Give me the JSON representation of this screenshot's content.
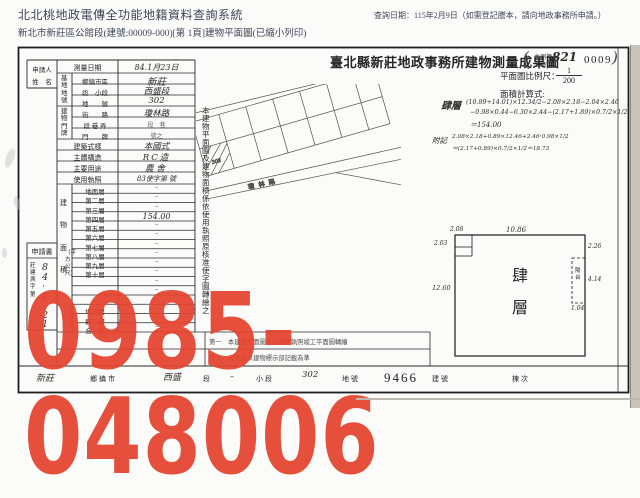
{
  "header": {
    "system_title": "北北桃地政電傳全功能地籍資料查詢系統",
    "query_date": "查詢日期：115年2月9日（如需登記謄本，請向地政事務所申請。）",
    "doc_line": "新北市新莊區公館段(建號:00009-000)[第 1頁]建物平面圖(已縮小列印)"
  },
  "form": {
    "title": "臺北縣新莊地政事務所建物測量成果圖",
    "stamp": {
      "open": "(",
      "line1": "主測複",
      "line2": "公繪字",
      "hand_number": "821",
      "typed_number": "0009",
      "close": ")"
    },
    "scale": {
      "label": "平面圖比例尺：",
      "numerator": "1",
      "denominator": "200"
    },
    "calc": {
      "label": "面積計算式:",
      "floor": "肆層",
      "line1": "(10.89+14.01)×12.34/2−2.08×2.18−2.04×2.46",
      "line2": "−0.98×0.44−6.30×2.44−(2.17+1.89)×0.7/2×1/2",
      "line3": "＝154.00",
      "note_label": "附記",
      "note1": "2.08×2.18+0.89×12.46+2.46·0.98×1/2",
      "note2": "＝(2.17+0.89)×0.7/2×1/2＝18.73"
    },
    "applicant": {
      "line1": "申請人",
      "line2": "姓　名"
    },
    "rows": {
      "survey_date": {
        "label": "測量日期",
        "value": "84.1月23日"
      },
      "site_group": "基地地號",
      "township": {
        "label": "鄉鎮市區",
        "value": "新莊"
      },
      "section": {
        "label": "段　小段",
        "value": "西盛段"
      },
      "parcel": {
        "label": "地　　號",
        "value": "302"
      },
      "door_group": "建物門牌",
      "street": {
        "label": "街　　路",
        "value": "瓊林路"
      },
      "lane": {
        "label": "段 巷 弄",
        "value": "段　巷"
      },
      "door": {
        "label": "門　　牌",
        "value": "號之"
      },
      "style": {
        "label": "建築式樣",
        "value": "本國式"
      },
      "structure": {
        "label": "主體構造",
        "value": "RC造"
      },
      "usage": {
        "label": "主要用途",
        "value": "農舍"
      },
      "license": {
        "label": "使用執照",
        "value": "83使字第 號"
      }
    },
    "area_group": {
      "label": "建物面積",
      "unit": "（平方公尺）"
    },
    "floors": [
      {
        "label": "地面層",
        "value": "",
        "dash": "–"
      },
      {
        "label": "第二層",
        "value": "",
        "dash": "–"
      },
      {
        "label": "第三層",
        "value": "",
        "dash": "–"
      },
      {
        "label": "第四層",
        "value": "154.00",
        "dash": ""
      },
      {
        "label": "第五層",
        "value": "",
        "dash": "–"
      },
      {
        "label": "第六層",
        "value": "",
        "dash": "–"
      },
      {
        "label": "第七層",
        "value": "",
        "dash": "–"
      },
      {
        "label": "第八層",
        "value": "",
        "dash": "–"
      },
      {
        "label": "第九層",
        "value": "",
        "dash": "–"
      },
      {
        "label": "第十層",
        "value": "",
        "dash": "–"
      },
      {
        "label": "",
        "value": "",
        "dash": "–"
      },
      {
        "label": "",
        "value": "",
        "dash": "–"
      },
      {
        "label": "",
        "value": "",
        "dash": "–"
      },
      {
        "label": "地下層",
        "value": "",
        "dash": "–"
      },
      {
        "label": "騎　樓",
        "value": "",
        "dash": "–"
      },
      {
        "label": "合　計",
        "value": "",
        "dash": "–"
      }
    ],
    "notes": {
      "n1": "第一　本建物平面圖係依使用執照竣工平面圖轉繪",
      "n2": "第二　成果圖以建物標示部記載為準"
    },
    "receipt": {
      "title": "申請書",
      "prefix": "莊建測字第",
      "number": "84·1·21"
    },
    "vertical_note": "本建物平面圖及建物面積係依使用執照原核准使字圖轉繪之",
    "strip": {
      "v1": "新莊",
      "l1": "鄉鎮市",
      "v2": "西盛",
      "l2": "段",
      "v3": "–",
      "l3": "小段",
      "v4": "302",
      "l4": "地號",
      "building_no": "9466",
      "l5": "建號",
      "l6": "棟次"
    },
    "drawing": {
      "floor_char1": "肆",
      "floor_char2": "層",
      "dim_top": "10.86",
      "dim_left": "12.60",
      "notch_top": "2.08",
      "notch_left": "2.03",
      "right_top": "2.26",
      "balcony_dim": "4.14",
      "balcony_bottom": "1.04",
      "balcony_label": "陽台"
    },
    "sketch": {
      "road_label": "瓊林路",
      "parcel_number": "302"
    }
  },
  "watermark": {
    "text": "0985-048006",
    "color": "#e54531"
  }
}
